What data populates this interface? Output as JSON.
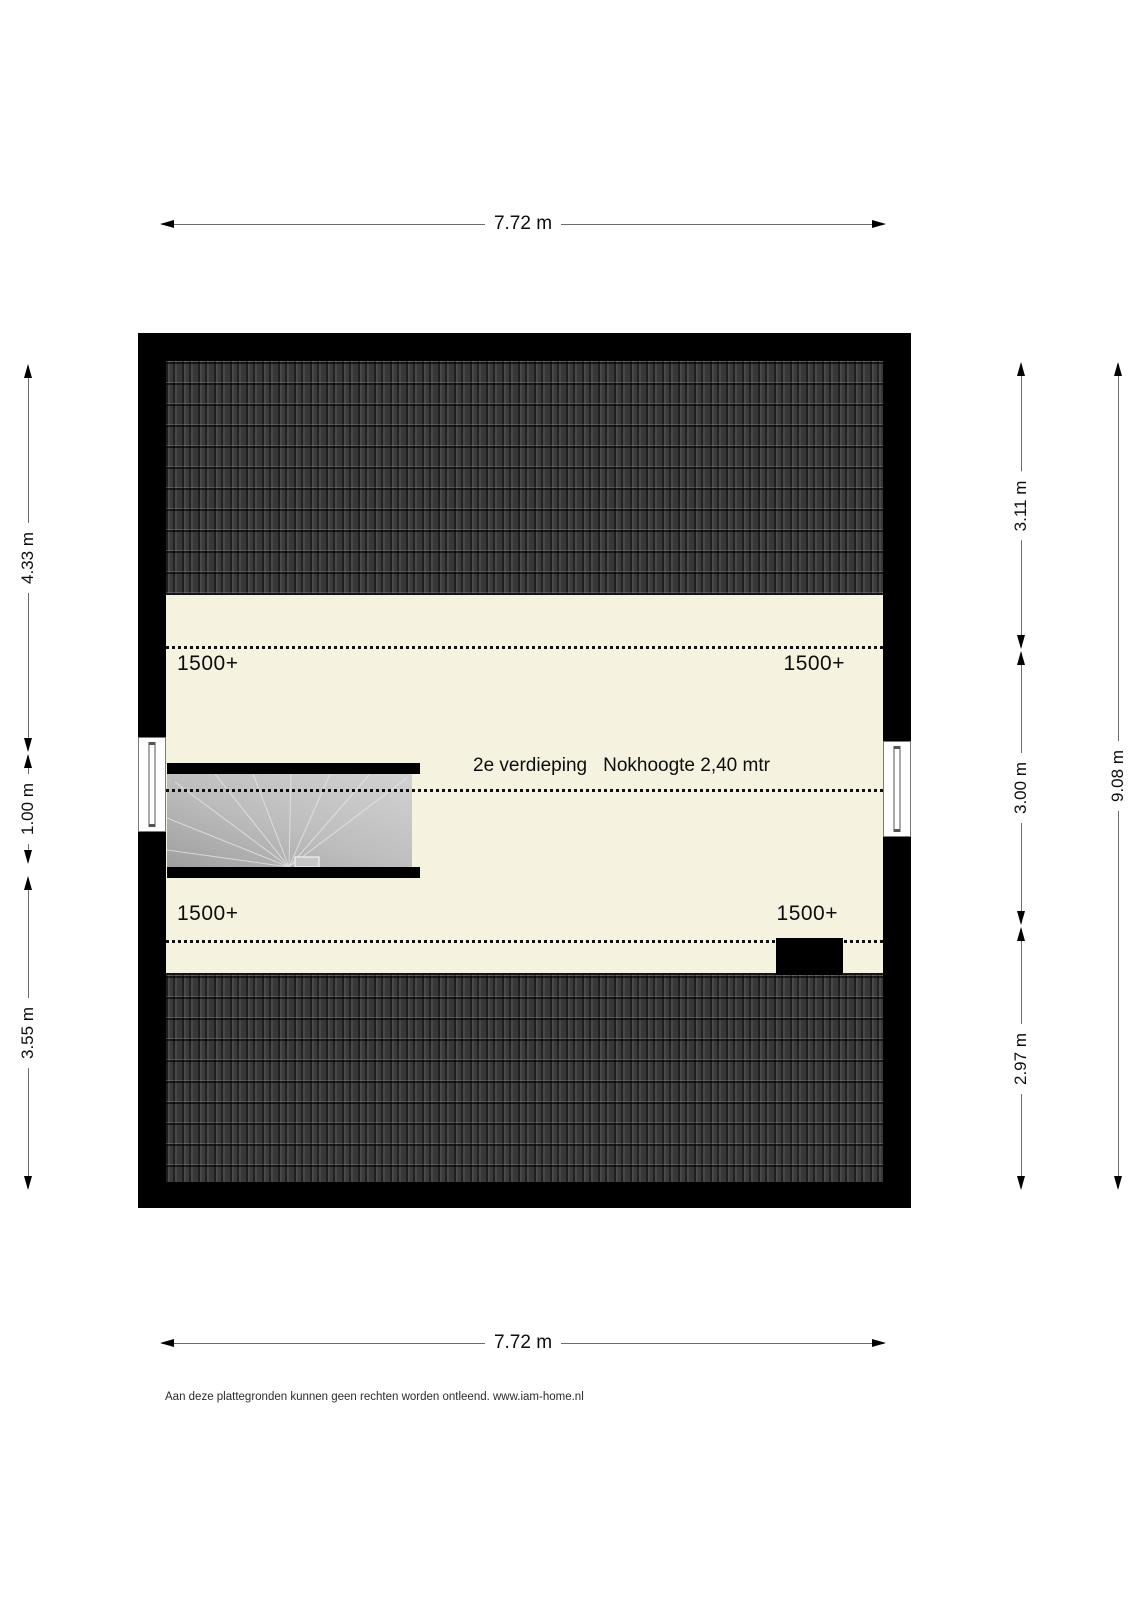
{
  "plan": {
    "floor_label": "2e verdieping",
    "ridge_label": "Nokhoogte 2,40 mtr",
    "height_marks": [
      "1500+",
      "1500+",
      "1500+",
      "1500+"
    ]
  },
  "dimensions": {
    "top": "7.72 m",
    "bottom": "7.72 m",
    "left": [
      "4.33 m",
      "1.00 m",
      "3.55 m"
    ],
    "right_inner": [
      "3.11 m",
      "3.00 m",
      "2.97 m"
    ],
    "right_outer": "9.08 m"
  },
  "footer": {
    "disclaimer": "Aan deze plattegronden kunnen geen rechten worden ontleend. www.iam-home.nl"
  },
  "colors": {
    "floor": "#f5f2df",
    "roof": "#303030",
    "wall": "#000000",
    "stairs": "#bdbdbd",
    "dimension_text": "#0d0d0d"
  }
}
